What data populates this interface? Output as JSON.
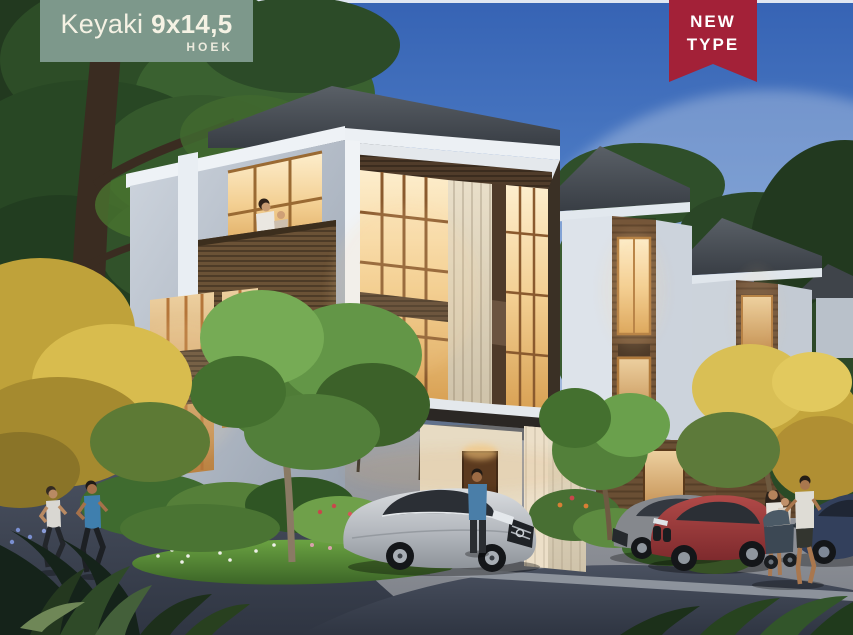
{
  "badge": {
    "product_name": "Keyaki",
    "dimensions": "9x14,5",
    "variant": "HOEK"
  },
  "ribbon": {
    "line1": "NEW",
    "line2": "TYPE"
  },
  "colors": {
    "badge_bg": "#7d988b",
    "badge_text": "#f5f2e4",
    "ribbon_bg": "#a32138",
    "ribbon_text": "#ffffff"
  }
}
